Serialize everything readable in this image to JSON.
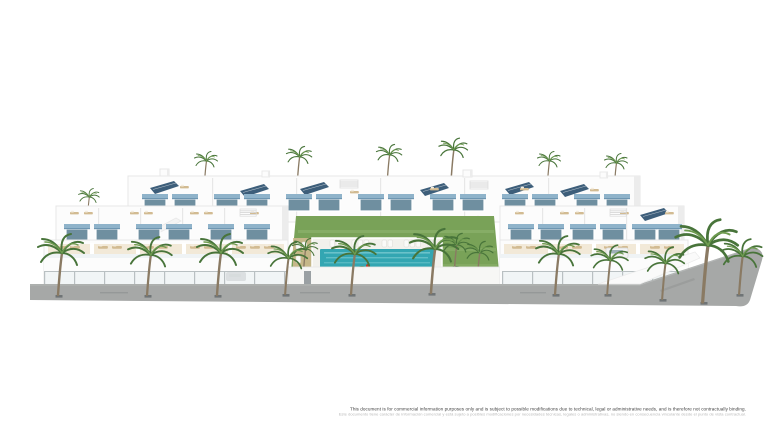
{
  "image": {
    "kind": "architectural-3d-render",
    "subject": "Front aerial render of a white modern residential complex with stepped roof terraces, blue window awnings, rooftop solar panels, a central landscaped courtyard with communal swimming pool and sun loungers, rows of palm trees and a grey street running along the front and wrapping the right corner",
    "background": "plain white"
  },
  "scene": {
    "elements": [
      "townhouse-blocks",
      "roof-terraces",
      "solar-panels",
      "blue-awnings",
      "pergolas",
      "central-garden",
      "swimming-pool",
      "pool-deck",
      "sun-loungers",
      "tropical-plants",
      "palm-trees",
      "glass-balustrades",
      "perimeter-wall",
      "street",
      "tree-grates",
      "parked-cars"
    ]
  },
  "disclaimer": {
    "line1_en": "This document is for commercial information purposes only and is subject to possible modifications due to technical, legal or administrative needs, and is therefore not contractually binding.",
    "line2_es": "Este documento tiene carácter de información comercial y está sujeto a posibles modificaciones por necesidades técnicas, legales o administrativas, no siendo en consecuencia vinculante desde el punto de vista contractual."
  },
  "colors": {
    "background": "#ffffff",
    "facade": "#fcfcfc",
    "facade_edge": "#e7e7e7",
    "facade_shadow": "#ececec",
    "awning_blue": "#8fb3ca",
    "awning_blue_dark": "#6e96b1",
    "glass": "#6f8fa0",
    "solar_panel": "#3d5e7a",
    "terrace_sand": "#ead9ba",
    "lounger_wood": "#d2bb92",
    "lawn_green": "#79a258",
    "lawn_light": "#9cbd7c",
    "pool_teal": "#33a6b2",
    "pool_light": "#8fd6da",
    "street_gray": "#a6a8a7",
    "street_dark": "#8f9291",
    "fence_glass": "#eef3f4",
    "fence_post": "#b9c0c2",
    "wall_white": "#f7f7f5",
    "palm_green": "#48743a",
    "palm_light": "#6f9c50",
    "plant_dark": "#3e6b31",
    "trunk_brown": "#8a7a63",
    "accent_red": "#c0392b",
    "disclaimer_dark": "#3f3f3f",
    "disclaimer_light": "#b8b8b8"
  }
}
